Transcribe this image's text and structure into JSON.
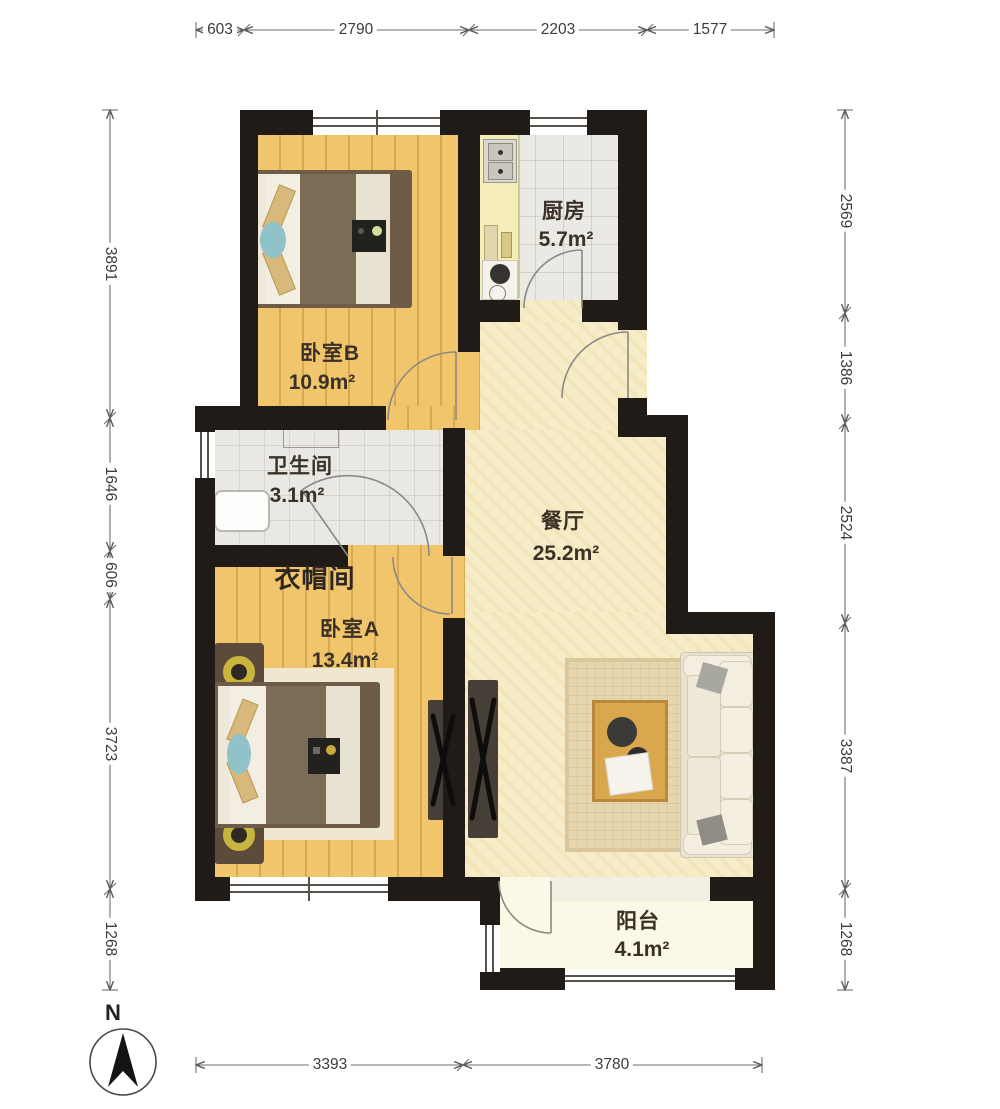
{
  "rooms": {
    "bedroom_b": {
      "name": "卧室B",
      "area": "10.9m²"
    },
    "kitchen": {
      "name": "厨房",
      "area": "5.7m²"
    },
    "bathroom": {
      "name": "卫生间",
      "area": "3.1m²"
    },
    "cloakroom": {
      "name": "衣帽间"
    },
    "bedroom_a": {
      "name": "卧室A",
      "area": "13.4m²"
    },
    "dining": {
      "name": "餐厅",
      "area": "25.2m²"
    },
    "balcony": {
      "name": "阳台",
      "area": "4.1m²"
    }
  },
  "dimensions": {
    "top": [
      "603",
      "2790",
      "2203",
      "1577"
    ],
    "left": [
      "3891",
      "1646",
      "606",
      "3723",
      "1268"
    ],
    "right": [
      "2569",
      "1386",
      "2524",
      "3387",
      "1268"
    ],
    "bottom": [
      "3393",
      "3780"
    ]
  },
  "compass": {
    "label": "N"
  },
  "palette": {
    "wall": "#201b16",
    "wood_floor": "#f0c56c",
    "dining_floor": "#f6edc8",
    "tile_floor": "#eae9e3",
    "balcony_floor": "#fbf8e6",
    "kitchen_counter": "#f5eebb",
    "bed_blanket": "#7d6c55",
    "accent_teal": "#8fc3c9",
    "sofa": "#e9e2cf",
    "rug": "#e5d6ae",
    "table_wood": "#d9a84e",
    "lamp_gold": "#c9b53e"
  }
}
